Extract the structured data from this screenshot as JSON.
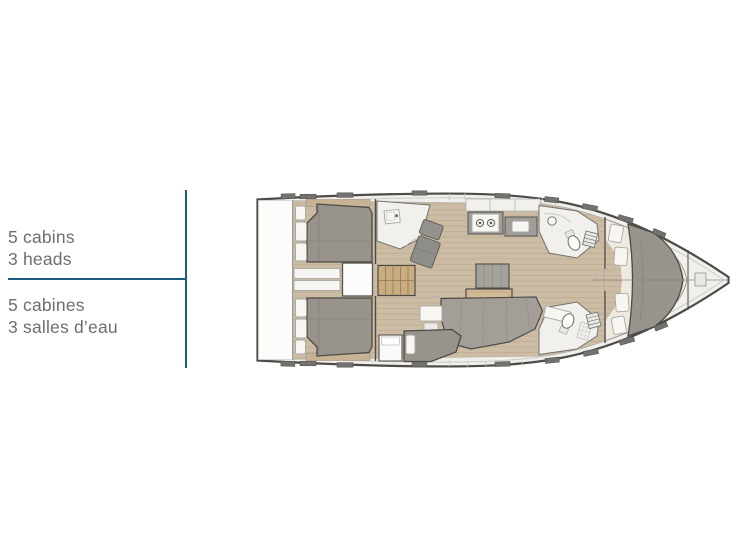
{
  "legend": {
    "english": {
      "line1": "5 cabins",
      "line2": "3 heads"
    },
    "french": {
      "line1": "5 cabines",
      "line2": "3 salles d’eau"
    }
  },
  "colors": {
    "accent": "#1c5c80",
    "text": "#6e6e6e",
    "outline": "#4c4b47",
    "deck": "#f0efec",
    "wood": "#cdbca4",
    "bed": "#98938b",
    "sofa": "#a39e97",
    "table-wood": "#d2bb97",
    "stair-wood": "#c9ad80",
    "counter": "#9f9e99",
    "hatch": "#73726e",
    "white-item": "#f7f6f3",
    "room": "#f1f0ec",
    "seam": "#c6c5c1"
  }
}
